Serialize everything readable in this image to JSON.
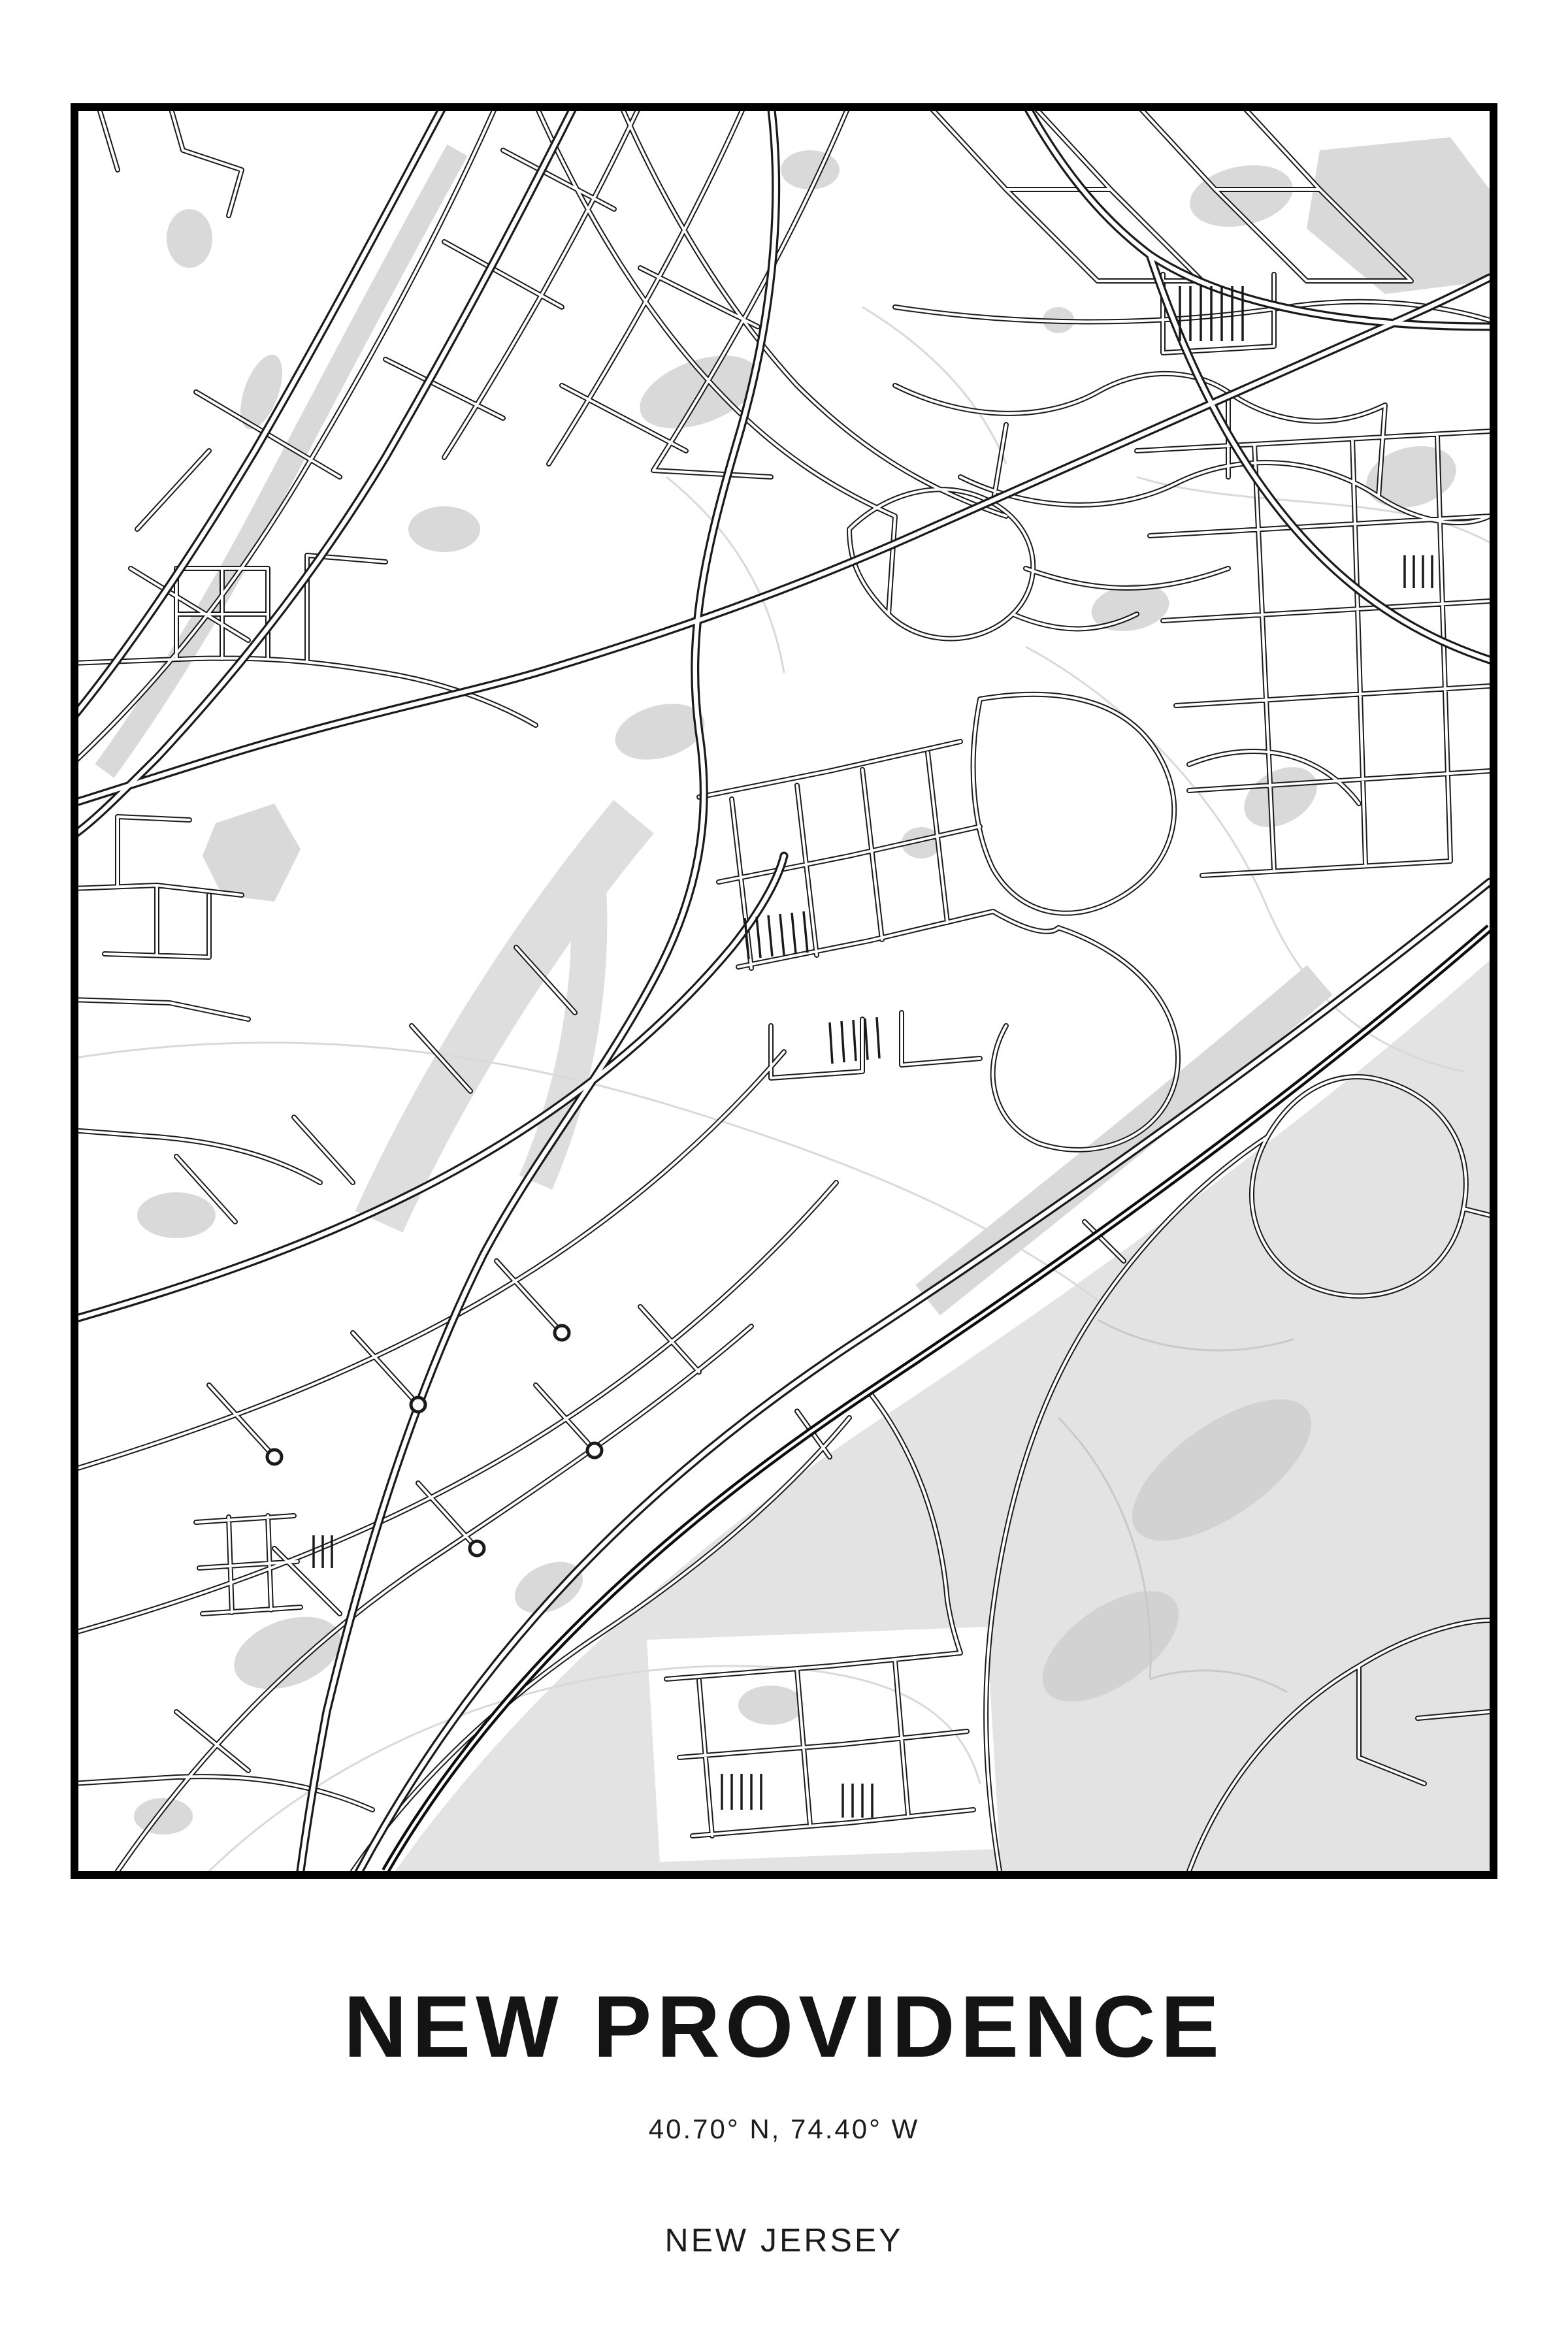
{
  "poster": {
    "title": "NEW PROVIDENCE",
    "coordinates": "40.70° N, 74.40° W",
    "region": "NEW JERSEY"
  },
  "map": {
    "description": "Monochrome framed street map of New Providence, New Jersey with railroad line and shaded park areas",
    "colors": {
      "bg": "#ffffff",
      "ink": "#141414",
      "road_casing": "#1a1a1a",
      "road_fill": "#ffffff",
      "green": "#d9d9d9",
      "green_light": "#e3e3e3",
      "green_dark": "#d2d2d2",
      "contour": "#d9d9d9",
      "trail": "#c9c9c9",
      "frame": "#000000",
      "railroad": "#0d0d0d"
    }
  }
}
